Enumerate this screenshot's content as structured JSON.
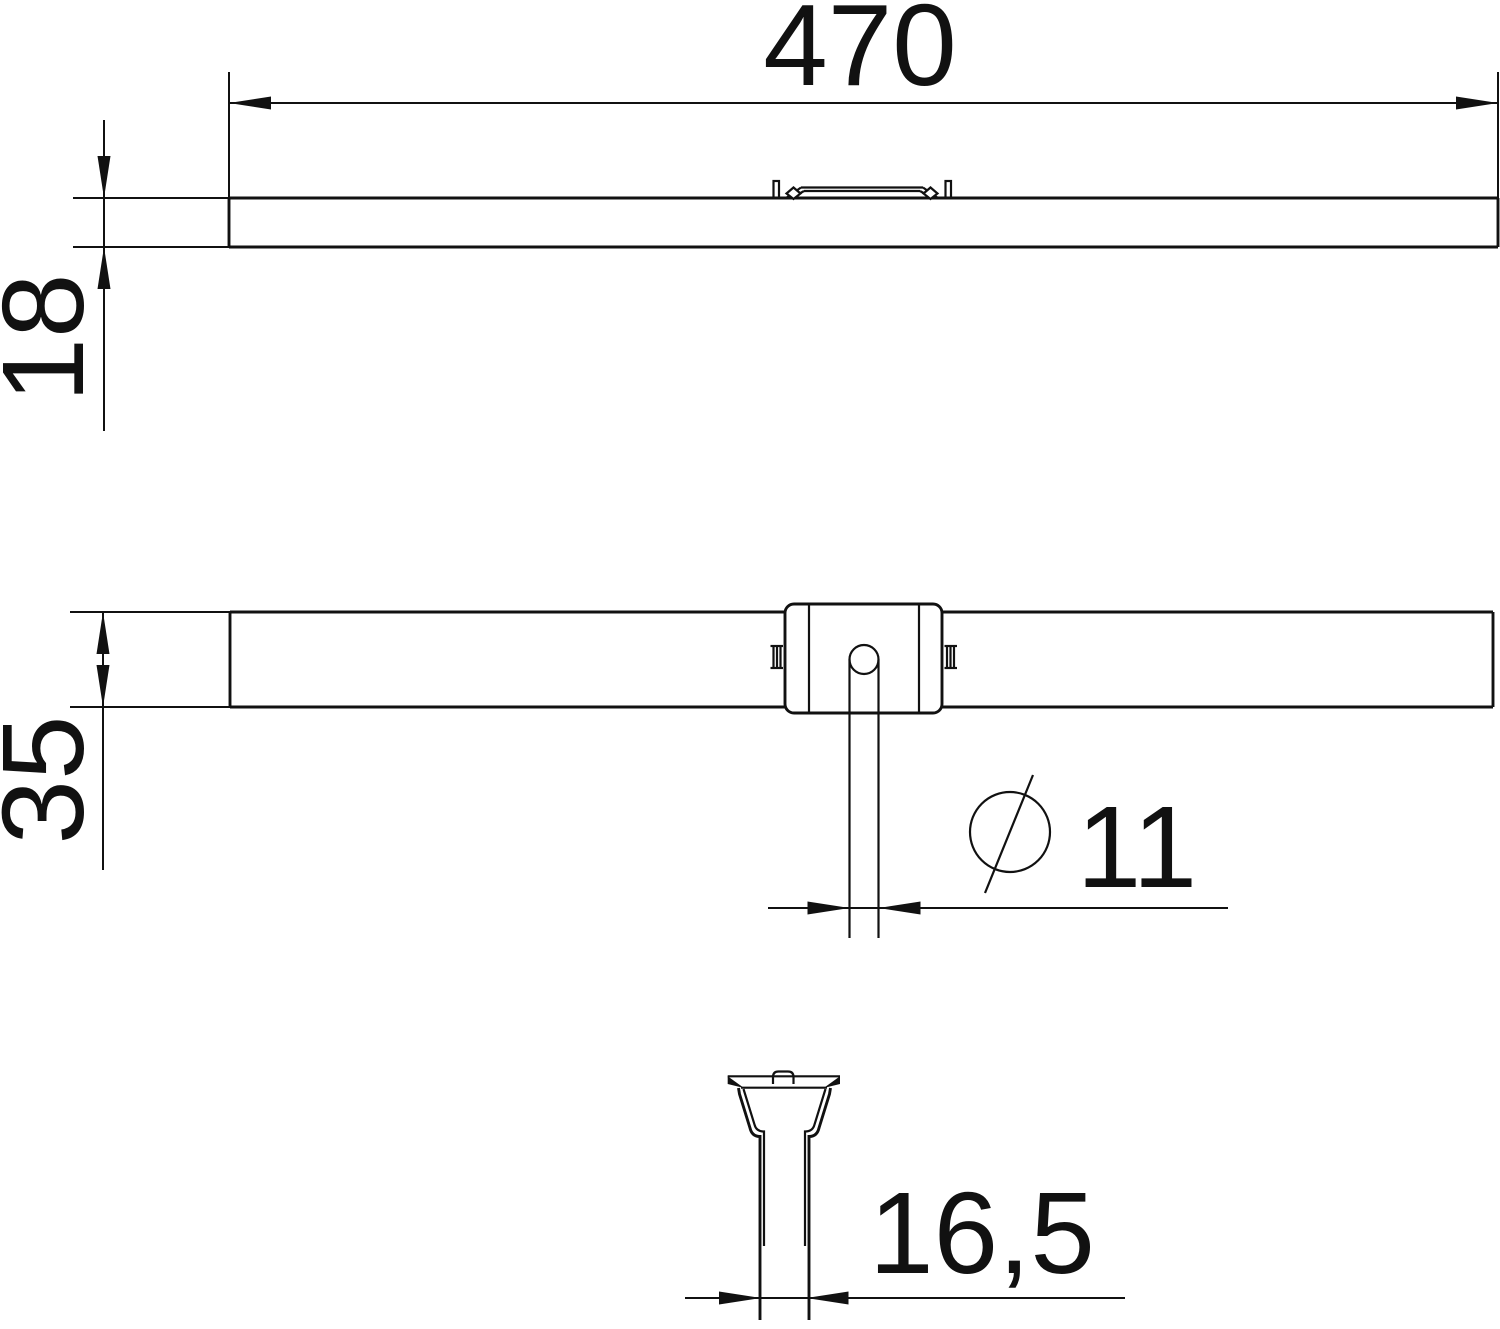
{
  "colors": {
    "background": "#ffffff",
    "line": "#111111",
    "text": "#111111"
  },
  "dimensions": {
    "length": {
      "value": "470"
    },
    "height": {
      "value": "18"
    },
    "width": {
      "value": "35"
    },
    "hole_diameter": {
      "value": "11",
      "symbol": "diameter-sign"
    },
    "slot_width": {
      "value": "16,5"
    }
  }
}
